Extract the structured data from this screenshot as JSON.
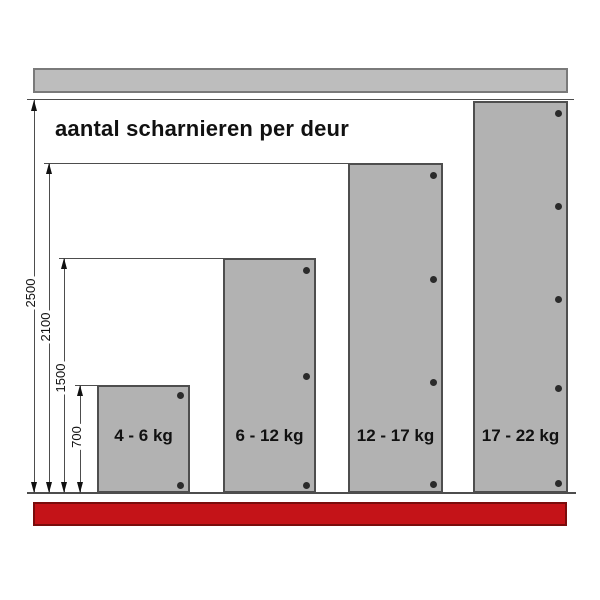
{
  "title": "aantal scharnieren per deur",
  "colors": {
    "door_fill": "#b2b2b2",
    "door_border": "#4e4e4e",
    "rail_fill": "#bdbdbd",
    "rail_border": "#7a7a7a",
    "floor_fill": "#c41318",
    "floor_border": "#7a0c0c",
    "line": "#4d4d4d",
    "dot": "#2b2b2b",
    "text": "#111111",
    "background": "#ffffff"
  },
  "doors": [
    {
      "label": "4 - 6 kg",
      "hinges": 2,
      "height_mm": 700,
      "x": 97,
      "top": 385,
      "width": 93,
      "dot_ys": [
        395,
        485
      ]
    },
    {
      "label": "6 - 12 kg",
      "hinges": 3,
      "height_mm": 1500,
      "x": 223,
      "top": 258,
      "width": 93,
      "dot_ys": [
        270,
        376,
        485
      ]
    },
    {
      "label": "12 - 17 kg",
      "hinges": 4,
      "height_mm": 2100,
      "x": 348,
      "top": 163,
      "width": 95,
      "dot_ys": [
        175,
        279,
        382,
        484
      ]
    },
    {
      "label": "17 - 22 kg",
      "hinges": 5,
      "height_mm": 2500,
      "x": 473,
      "top": 101,
      "width": 95,
      "dot_ys": [
        113,
        206,
        299,
        388,
        483
      ]
    }
  ],
  "dimensions": [
    {
      "label": "2500",
      "value_mm": 2500,
      "line_x": 34,
      "top_y": 100,
      "label_center_y": 293
    },
    {
      "label": "2100",
      "value_mm": 2100,
      "line_x": 49,
      "top_y": 163,
      "label_center_y": 327
    },
    {
      "label": "1500",
      "value_mm": 1500,
      "line_x": 64,
      "top_y": 258,
      "label_center_y": 378
    },
    {
      "label": "700",
      "value_mm": 700,
      "line_x": 80,
      "top_y": 385,
      "label_center_y": 437
    }
  ],
  "extension_lines": [
    {
      "y": 163,
      "x1": 44,
      "x2": 348
    },
    {
      "y": 258,
      "x1": 59,
      "x2": 223
    },
    {
      "y": 385,
      "x1": 75,
      "x2": 97
    }
  ],
  "guides": {
    "ceiling_line": {
      "y": 99,
      "x1": 27,
      "x2": 574
    },
    "floor_line": {
      "y": 492,
      "x1": 27,
      "x2": 576
    }
  },
  "rails": {
    "top": {
      "x": 33,
      "y": 68,
      "width": 535,
      "height": 25
    },
    "bottom": {
      "x": 33,
      "y": 502,
      "width": 534,
      "height": 24
    }
  },
  "label_row_y": 426,
  "baseline_y": 493
}
